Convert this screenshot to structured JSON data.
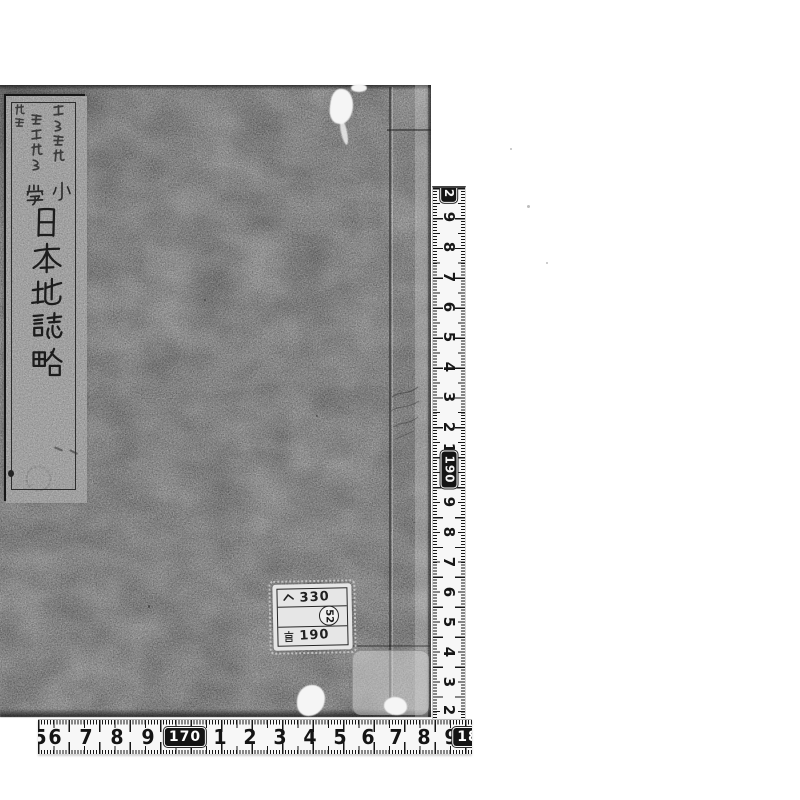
{
  "colors": {
    "page_background": "#ffffff",
    "cover_gray": "#9b9b9b",
    "slip_gray": "#a8a8a8",
    "ink_black": "#1c1c1c",
    "ruler_white": "#f7f7f7",
    "ruler_box_black": "#141414"
  },
  "book": {
    "title_slip": {
      "title": "日本地誌略",
      "title_chars": [
        "日",
        "本",
        "地",
        "誌",
        "略"
      ],
      "subtitle": "小學",
      "subtitle_chars": [
        "小",
        "學"
      ],
      "editors": {
        "column_right": "荒野文雄",
        "column_middle": "坂本英房",
        "column_left": "編輯"
      },
      "volume_marks": "ヽヽ"
    },
    "call_number_label": {
      "line1_symbol": "ヘ",
      "line1_number": "330",
      "line2_circled": "52",
      "line3_symbol": "宮",
      "line3_number": "190"
    }
  },
  "rulers": {
    "vertical": {
      "labels": [
        {
          "text": "2",
          "boxed": true
        },
        {
          "text": "9",
          "boxed": false
        },
        {
          "text": "8",
          "boxed": false
        },
        {
          "text": "7",
          "boxed": false
        },
        {
          "text": "6",
          "boxed": false
        },
        {
          "text": "5",
          "boxed": false
        },
        {
          "text": "4",
          "boxed": false
        },
        {
          "text": "3",
          "boxed": false
        },
        {
          "text": "2",
          "boxed": false
        },
        {
          "text": "1",
          "boxed": false
        },
        {
          "text": "190",
          "boxed": true
        },
        {
          "text": "9",
          "boxed": false
        },
        {
          "text": "8",
          "boxed": false
        },
        {
          "text": "7",
          "boxed": false
        },
        {
          "text": "6",
          "boxed": false
        },
        {
          "text": "5",
          "boxed": false
        },
        {
          "text": "4",
          "boxed": false
        },
        {
          "text": "3",
          "boxed": false
        },
        {
          "text": "2",
          "boxed": false
        }
      ]
    },
    "horizontal": {
      "labels": [
        {
          "text": "5",
          "boxed": false
        },
        {
          "text": "6",
          "boxed": false
        },
        {
          "text": "7",
          "boxed": false
        },
        {
          "text": "8",
          "boxed": false
        },
        {
          "text": "9",
          "boxed": false
        },
        {
          "text": "170",
          "boxed": true
        },
        {
          "text": "1",
          "boxed": false
        },
        {
          "text": "2",
          "boxed": false
        },
        {
          "text": "3",
          "boxed": false
        },
        {
          "text": "4",
          "boxed": false
        },
        {
          "text": "5",
          "boxed": false
        },
        {
          "text": "6",
          "boxed": false
        },
        {
          "text": "7",
          "boxed": false
        },
        {
          "text": "8",
          "boxed": false
        },
        {
          "text": "9",
          "boxed": false
        },
        {
          "text": "18",
          "boxed": true
        }
      ]
    }
  }
}
